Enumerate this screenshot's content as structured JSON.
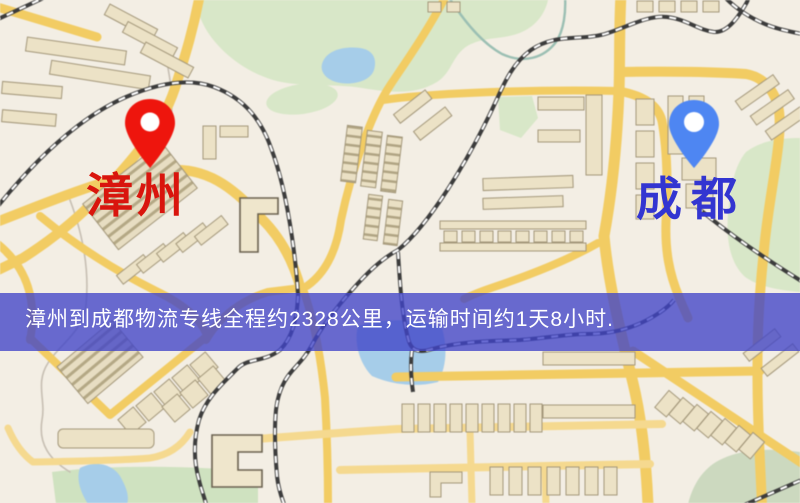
{
  "map": {
    "markers": [
      {
        "id": "origin",
        "label": "漳州",
        "pin_color": "#ee150d",
        "label_color": "#d9150d"
      },
      {
        "id": "destination",
        "label": "成都",
        "pin_color": "#4e86f2",
        "label_color": "#3335d1"
      }
    ],
    "banner": {
      "text": "漳州到成都物流专线全程约2328公里，运输时间约1天8小时.",
      "background": "#4044c8",
      "text_color": "#ffffff"
    },
    "palette": {
      "background": "#f3eee4",
      "road": "#f2cc63",
      "park": "#d8e7c8",
      "water": "#a6cde9",
      "building": "#ece2c6",
      "railway": "#3c3c3c"
    }
  }
}
